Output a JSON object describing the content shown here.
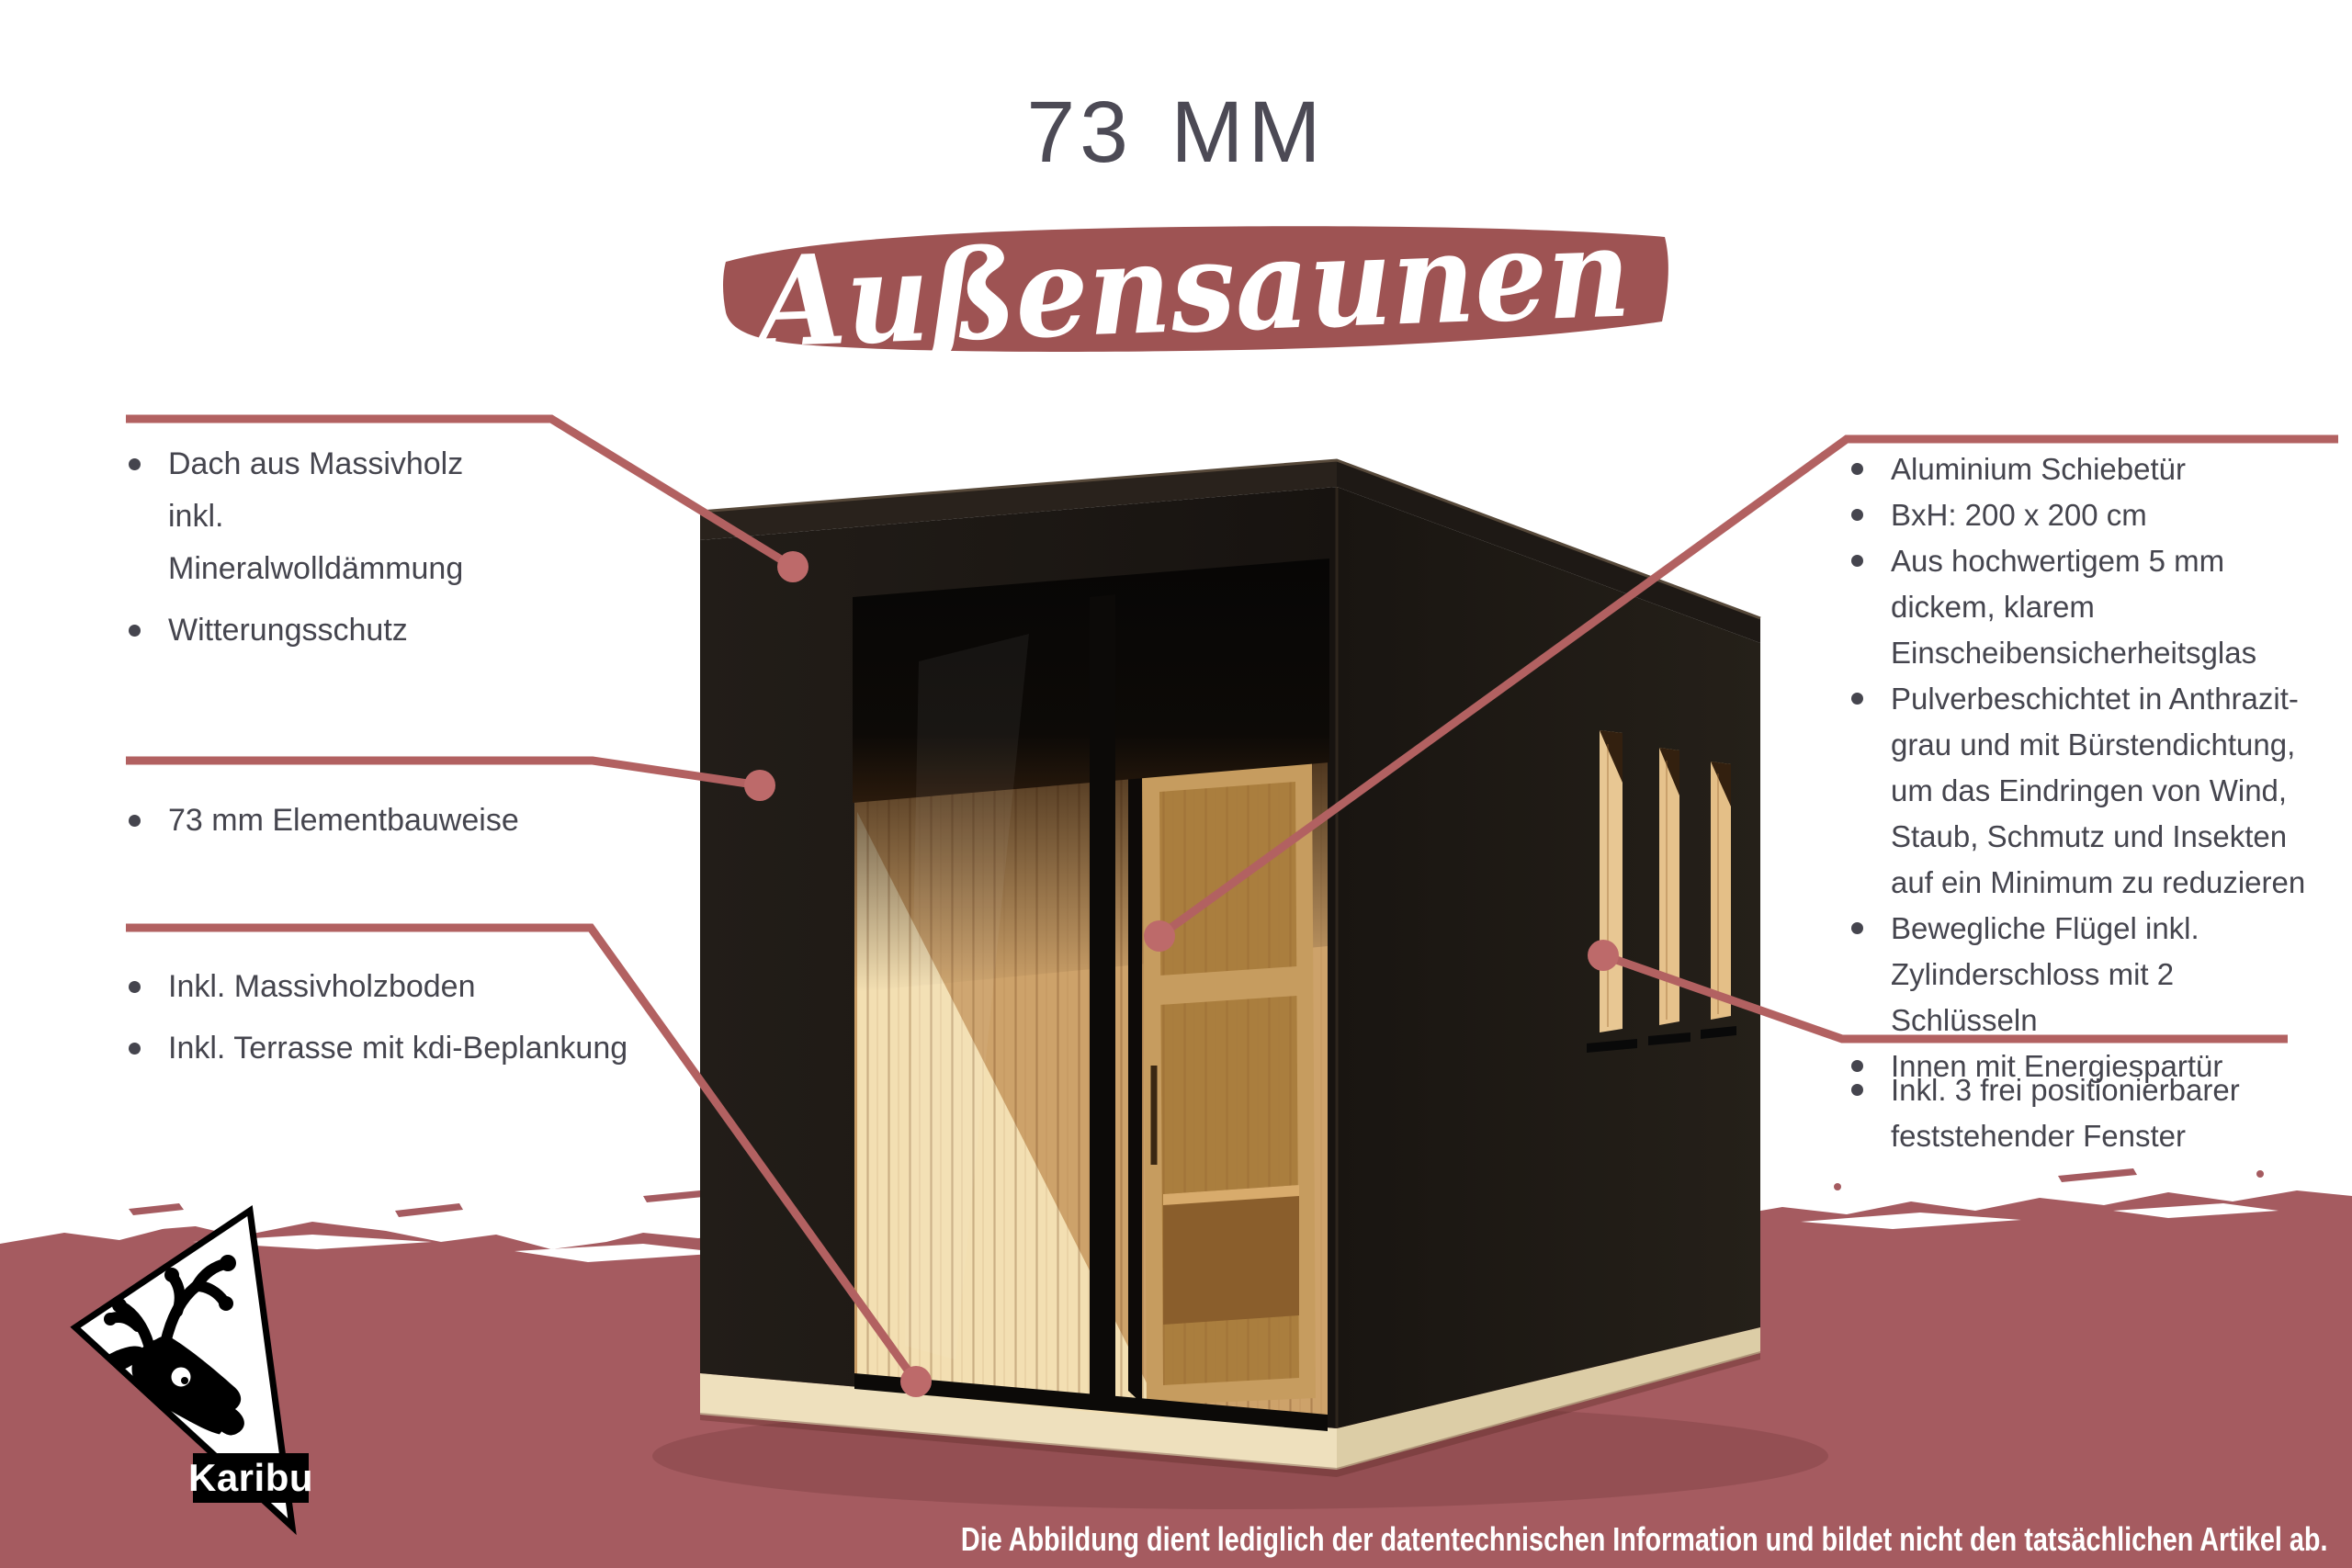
{
  "title": "73 MM",
  "banner": {
    "text": "Außensaunen"
  },
  "annotations": {
    "left": [
      {
        "items": [
          "Dach aus Massivholz inkl. Mineralwolldämmung",
          "Witterungsschutz"
        ]
      },
      {
        "items": [
          "73 mm Elementbauweise"
        ]
      },
      {
        "items": [
          "Inkl. Massivholzboden",
          "Inkl. Terrasse mit kdi-Beplankung"
        ]
      }
    ],
    "right": [
      {
        "items": [
          "Aluminium Schiebetür",
          "BxH: 200 x 200 cm",
          "Aus hochwertigem 5 mm dickem, klarem Einscheibensicherheitsglas",
          "Pulverbeschichtet in Anthrazit-grau und mit Bürstendichtung, um das Eindringen von Wind, Staub, Schmutz und Insekten auf ein Minimum zu reduzieren",
          "Bewegliche Flügel inkl. Zylinderschloss mit 2 Schlüsseln",
          "Innen mit Energiespartür"
        ]
      },
      {
        "items": [
          "Inkl. 3 frei positionierbarer feststehender Fenster"
        ]
      }
    ]
  },
  "footer": {
    "disclaimer": "Die Abbildung dient lediglich der datentechnischen Information und bildet nicht den tatsächlichen Artikel ab."
  },
  "logo": {
    "text": "Karibu"
  },
  "colors": {
    "accent": "#a05656",
    "band": "#a55b60",
    "brush": "#9e5353",
    "line": "#b26161",
    "dot": "#bd6a6a",
    "ink": "#45454e",
    "title_ink": "#4c4a55",
    "footer_text": "#ffffff",
    "wall_dark": "#1b1613",
    "wood_light": "#e8c793",
    "wood_interior": "#cda26a"
  }
}
